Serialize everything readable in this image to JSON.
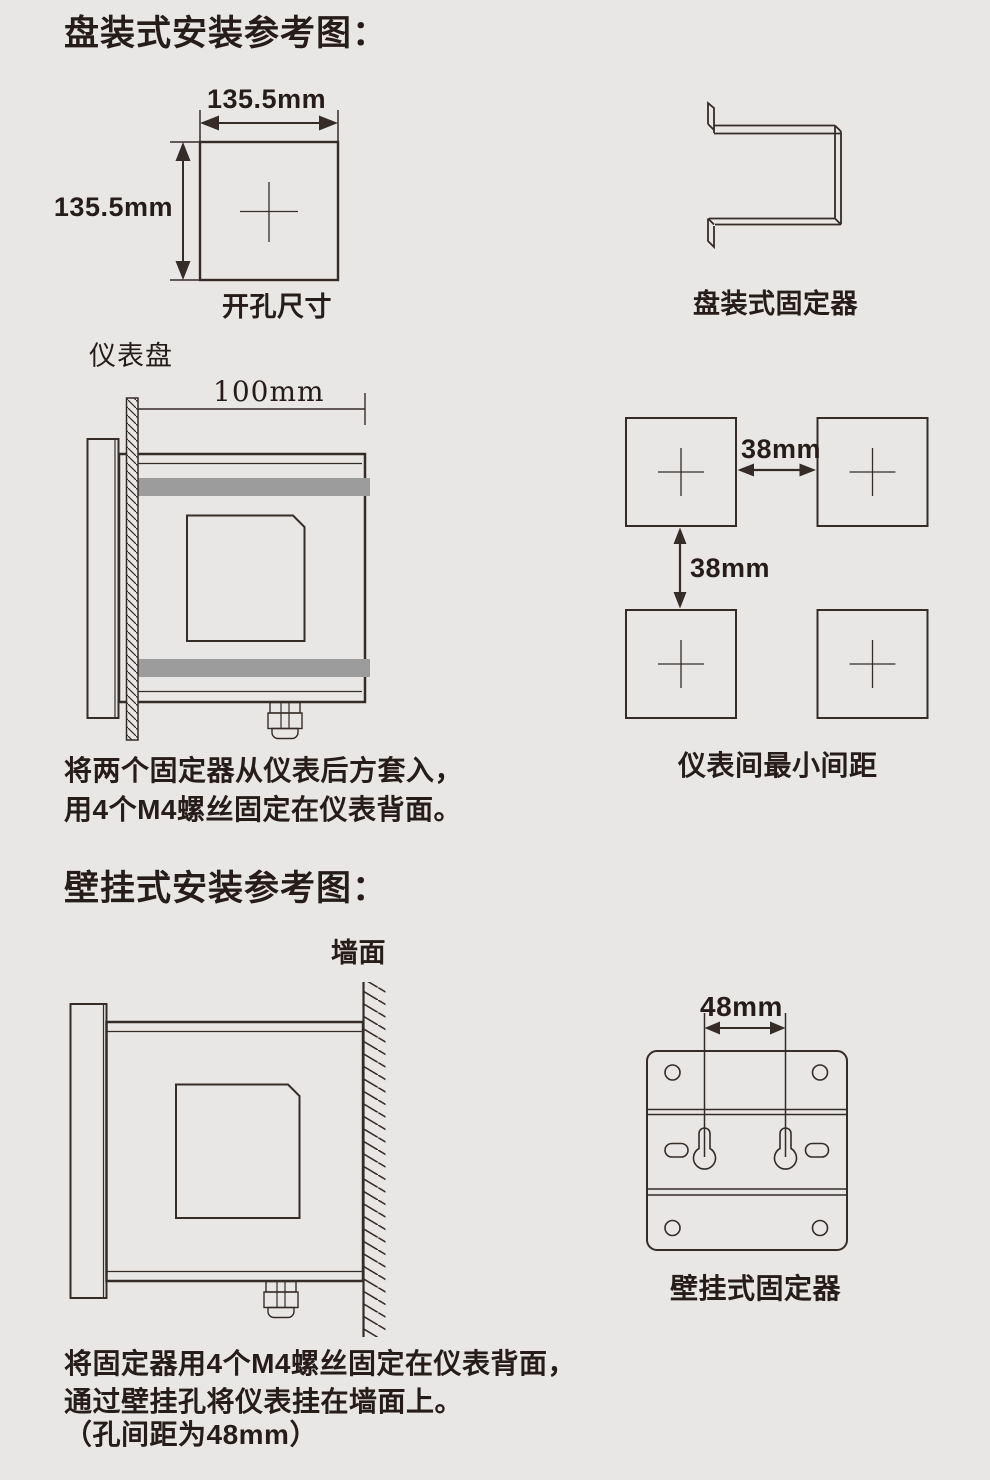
{
  "page": {
    "background": "#e9e7e6",
    "line_color": "#352c28",
    "text_color": "#261d1a",
    "band_color": "#9c9c9c"
  },
  "panel_mount": {
    "title": "盘装式安装参考图：",
    "cutout": {
      "width_label": "135.5mm",
      "height_label": "135.5mm",
      "caption": "开孔尺寸"
    },
    "fixer_caption": "盘装式固定器",
    "side_view": {
      "panel_label": "仪表盘",
      "depth_label": "100mm"
    },
    "spacing": {
      "horizontal_label": "38mm",
      "vertical_label": "38mm",
      "caption": "仪表间最小间距"
    },
    "note_line1": "将两个固定器从仪表后方套入，",
    "note_line2": "用4个M4螺丝固定在仪表背面。"
  },
  "wall_mount": {
    "title": "壁挂式安装参考图：",
    "wall_label": "墙面",
    "fixer": {
      "hole_pitch_label": "48mm",
      "caption": "壁挂式固定器"
    },
    "note_line1": "将固定器用4个M4螺丝固定在仪表背面，",
    "note_line2": "通过壁挂孔将仪表挂在墙面上。",
    "note_line3": "（孔间距为48mm）"
  }
}
